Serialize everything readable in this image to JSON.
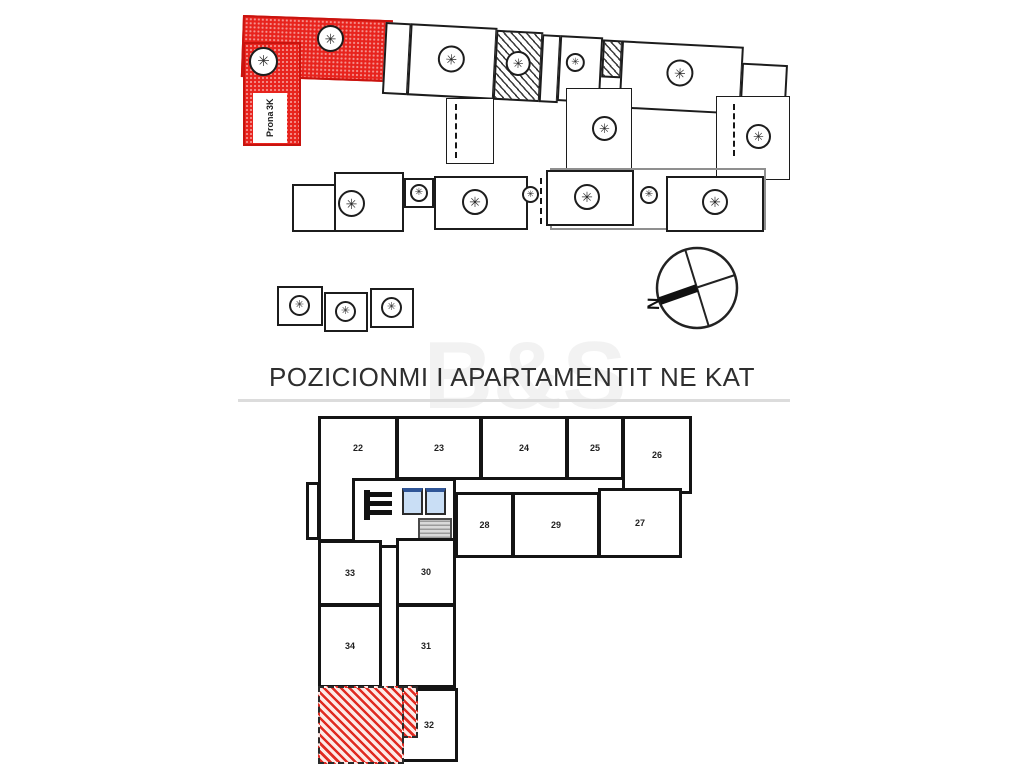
{
  "title": "POZICIONMI I APARTAMENTIT NE KAT",
  "watermark": "B&S",
  "site_plan": {
    "highlighted_unit_label": "Prona",
    "highlighted_unit_type": "3K",
    "compass_label": "N"
  },
  "floor_plan": {
    "rooms": {
      "r22": "22",
      "r23": "23",
      "r24": "24",
      "r25": "25",
      "r26": "26",
      "r27": "27",
      "r28": "28",
      "r29": "29",
      "r30": "30",
      "r31": "31",
      "r32": "32",
      "r33": "33",
      "r34": "34"
    },
    "highlighted_room_number": ""
  },
  "colors": {
    "highlight_red": "#e8231d",
    "elevator_blue": "#c9def5",
    "divider_gray": "#dcdcdc"
  }
}
